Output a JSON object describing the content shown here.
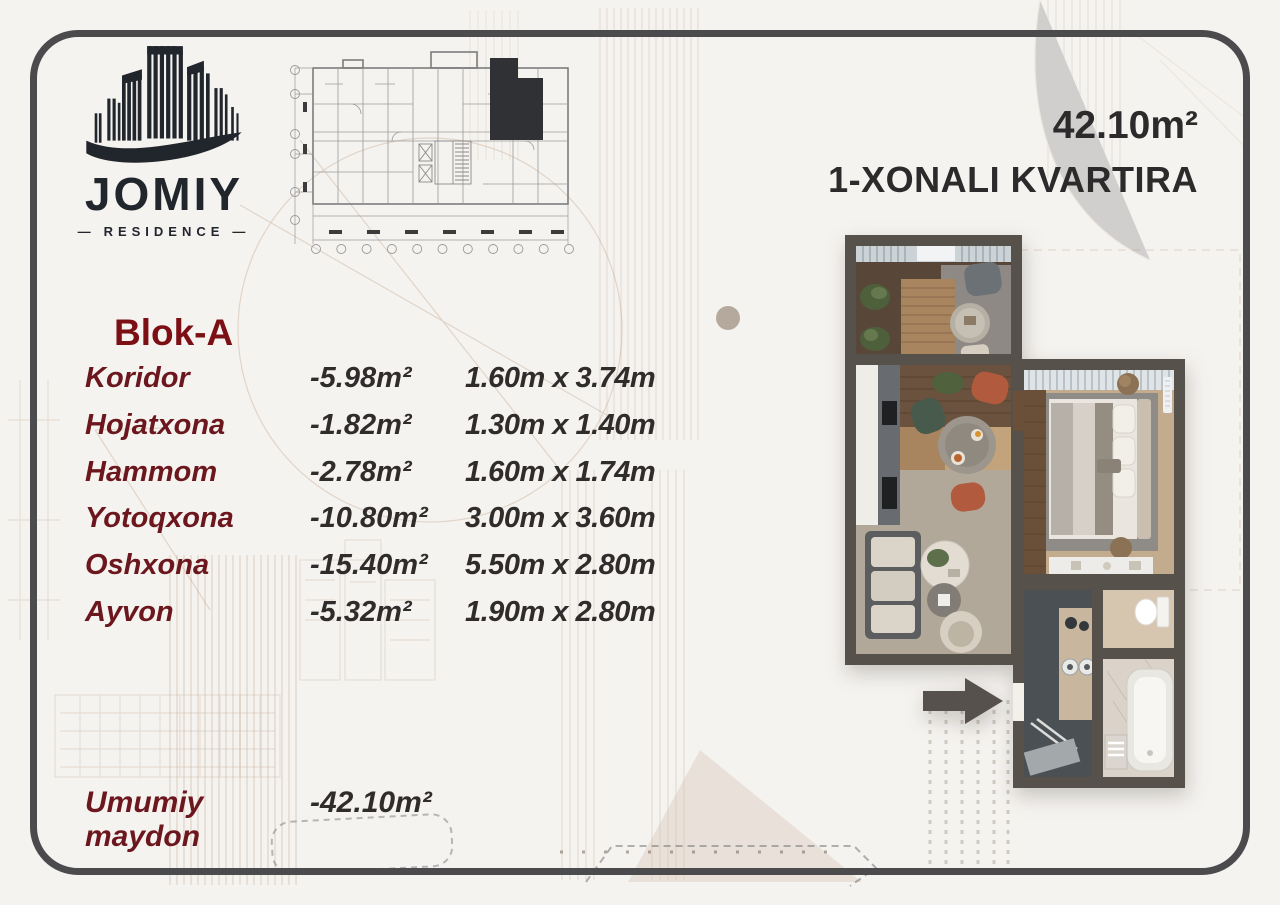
{
  "brand": {
    "name": "JOMIY",
    "tagline": "RESIDENCE",
    "dash": "—"
  },
  "header": {
    "area": "42.10m²",
    "title": "1-XONALI KVARTIRA"
  },
  "block_label": "Blok-A",
  "rooms": [
    {
      "name": "Koridor",
      "area": "-5.98m²",
      "dimensions": "1.60m x 3.74m"
    },
    {
      "name": "Hojatxona",
      "area": "-1.82m²",
      "dimensions": "1.30m x 1.40m"
    },
    {
      "name": "Hammom",
      "area": "-2.78m²",
      "dimensions": "1.60m x 1.74m"
    },
    {
      "name": "Yotoqxona",
      "area": "-10.80m²",
      "dimensions": "3.00m x 3.60m"
    },
    {
      "name": "Oshxona",
      "area": "-15.40m²",
      "dimensions": "5.50m x 2.80m"
    },
    {
      "name": "Ayvon",
      "area": "-5.32m²",
      "dimensions": "1.90m x 2.80m"
    }
  ],
  "total": {
    "label": "Umumiy maydon",
    "value": "-42.10m²"
  },
  "colors": {
    "brand_dark": "#21252c",
    "accent_maroon": "#6b171d",
    "block_red": "#7b0f14",
    "text_dark": "#2f2c2b",
    "frame_gray": "#4b4b4d",
    "plan_wall": "#57514c",
    "sepia_sketch": "#b99878",
    "terracotta_chair": "#b25a3d",
    "green_chair": "#475a4c"
  }
}
